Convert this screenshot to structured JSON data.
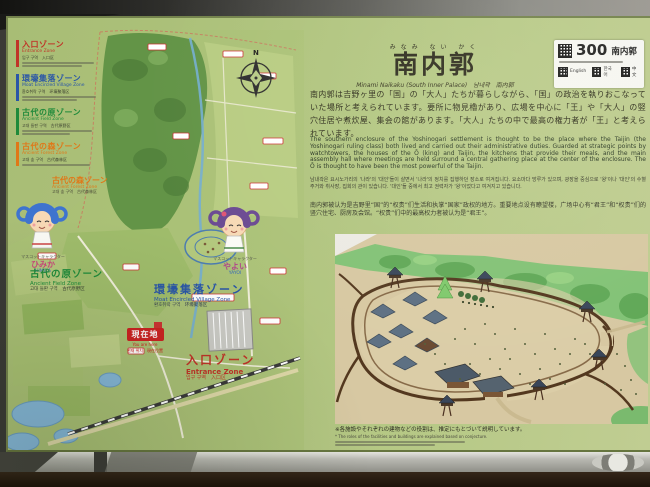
{
  "legend": {
    "items": [
      {
        "jp": "入口ゾーン",
        "en": "Entrance Zone",
        "krcn": "입구 구역　入口区",
        "color": "#c03428"
      },
      {
        "jp": "環壕集落ゾーン",
        "en": "Moat Encircled Village Zone",
        "krcn": "환호취락 구역　环壕聚落区",
        "color": "#2a56a7"
      },
      {
        "jp": "古代の原ゾーン",
        "en": "Ancient Field Zone",
        "krcn": "고대 들판 구역　古代原野区",
        "color": "#1f8a3a"
      },
      {
        "jp": "古代の森ゾーン",
        "en": "Ancient Forest Zone",
        "krcn": "고대 숲 구역　古代森林区",
        "color": "#e07818"
      }
    ]
  },
  "map": {
    "compass": "N",
    "forest_label": {
      "jp": "古代の森ゾーン",
      "en": "Ancient Forest Zone",
      "krcn": "고대 숲 구역　古代森林区"
    },
    "field_label": {
      "jp": "古代の原ゾーン",
      "en": "Ancient Field Zone",
      "krcn": "고대 들판 구역　古代原野区"
    },
    "village_label": {
      "jp": "環壕集落ゾーン",
      "en": "Moat Encircled Village Zone",
      "krcn": "환호취락 구역　环壕聚落区"
    },
    "entrance_label": {
      "jp": "入口ゾーン",
      "en": "Entrance Zone",
      "krcn": "입구 구역　入口区"
    },
    "current_location": {
      "jp": "現在地",
      "en": "You are here",
      "krcn": "현재 위치　現在位置"
    },
    "mascots": [
      {
        "role": "マスコットキャラクター",
        "name": "ひみか",
        "romaji": "HIMIKA"
      },
      {
        "role": "マスコットキャラクター",
        "name": "やよい",
        "romaji": "YAYOI"
      }
    ]
  },
  "header": {
    "furigana": "みなみ ない かく",
    "title": "南内郭",
    "subtitle": "Minami Naikaku (South Inner Palace)　남내곽　南内郭"
  },
  "qr_card": {
    "number": "300",
    "name": "南内郭",
    "langs": [
      "English",
      "한국어",
      "中文"
    ]
  },
  "paragraphs": {
    "jp": "南内郭は吉野ヶ里の「国」の「大人」たちが暮らしながら、「国」の政治を執りおこなっていた場所と考えられています。要所に物見櫓があり、広場を中心に「王」や「大人」の竪穴住居や煮炊屋、集会の館があります。「大人」たちの中で最高の権力者が「王」と考えられています。",
    "en": "The southern enclosure of the Yoshinogari settlement is thought to be the place where the Taijin (the Yoshinogari ruling class) both lived and carried out their administrative duties. Guarded at strategic points by watchtowers, the houses of the Ō (king) and Taijin, the kitchens that provide their meals, and the main assembly hall where meetings are held surround a central gathering place at the center of the enclosure. The Ō is thought to have been the most powerful of the Taijin.",
    "kr": "남내곽은 요시노가리의 '나라'의 '대인'들이 살면서 '나라'의 정치를 집행하던 장소로 여겨집니다. 요소마다 망루가 있으며, 광장을 중심으로 '왕'이나 '대인'의 수혈주거와 취사장, 집회의 관이 있습니다. '대인'들 중에서 최고 권력자가 '왕'이었다고 여겨지고 있습니다.",
    "cn": "南内郭被认为是吉野里“国”的“权贵”们生活和执掌“国家”政权的地方。重要地点设有瞭望楼，广场中心有“君王”和“权贵”们的竖穴住宅、厨房及会馆。“权贵”们中的最高权力者被认为是“君王”。"
  },
  "caption": {
    "jp": "※各施設やそれぞれの建物などの役割は、推定にもとづいて説明しています。",
    "en": "* The roles of the facilities and buildings are explained based on conjecture."
  }
}
